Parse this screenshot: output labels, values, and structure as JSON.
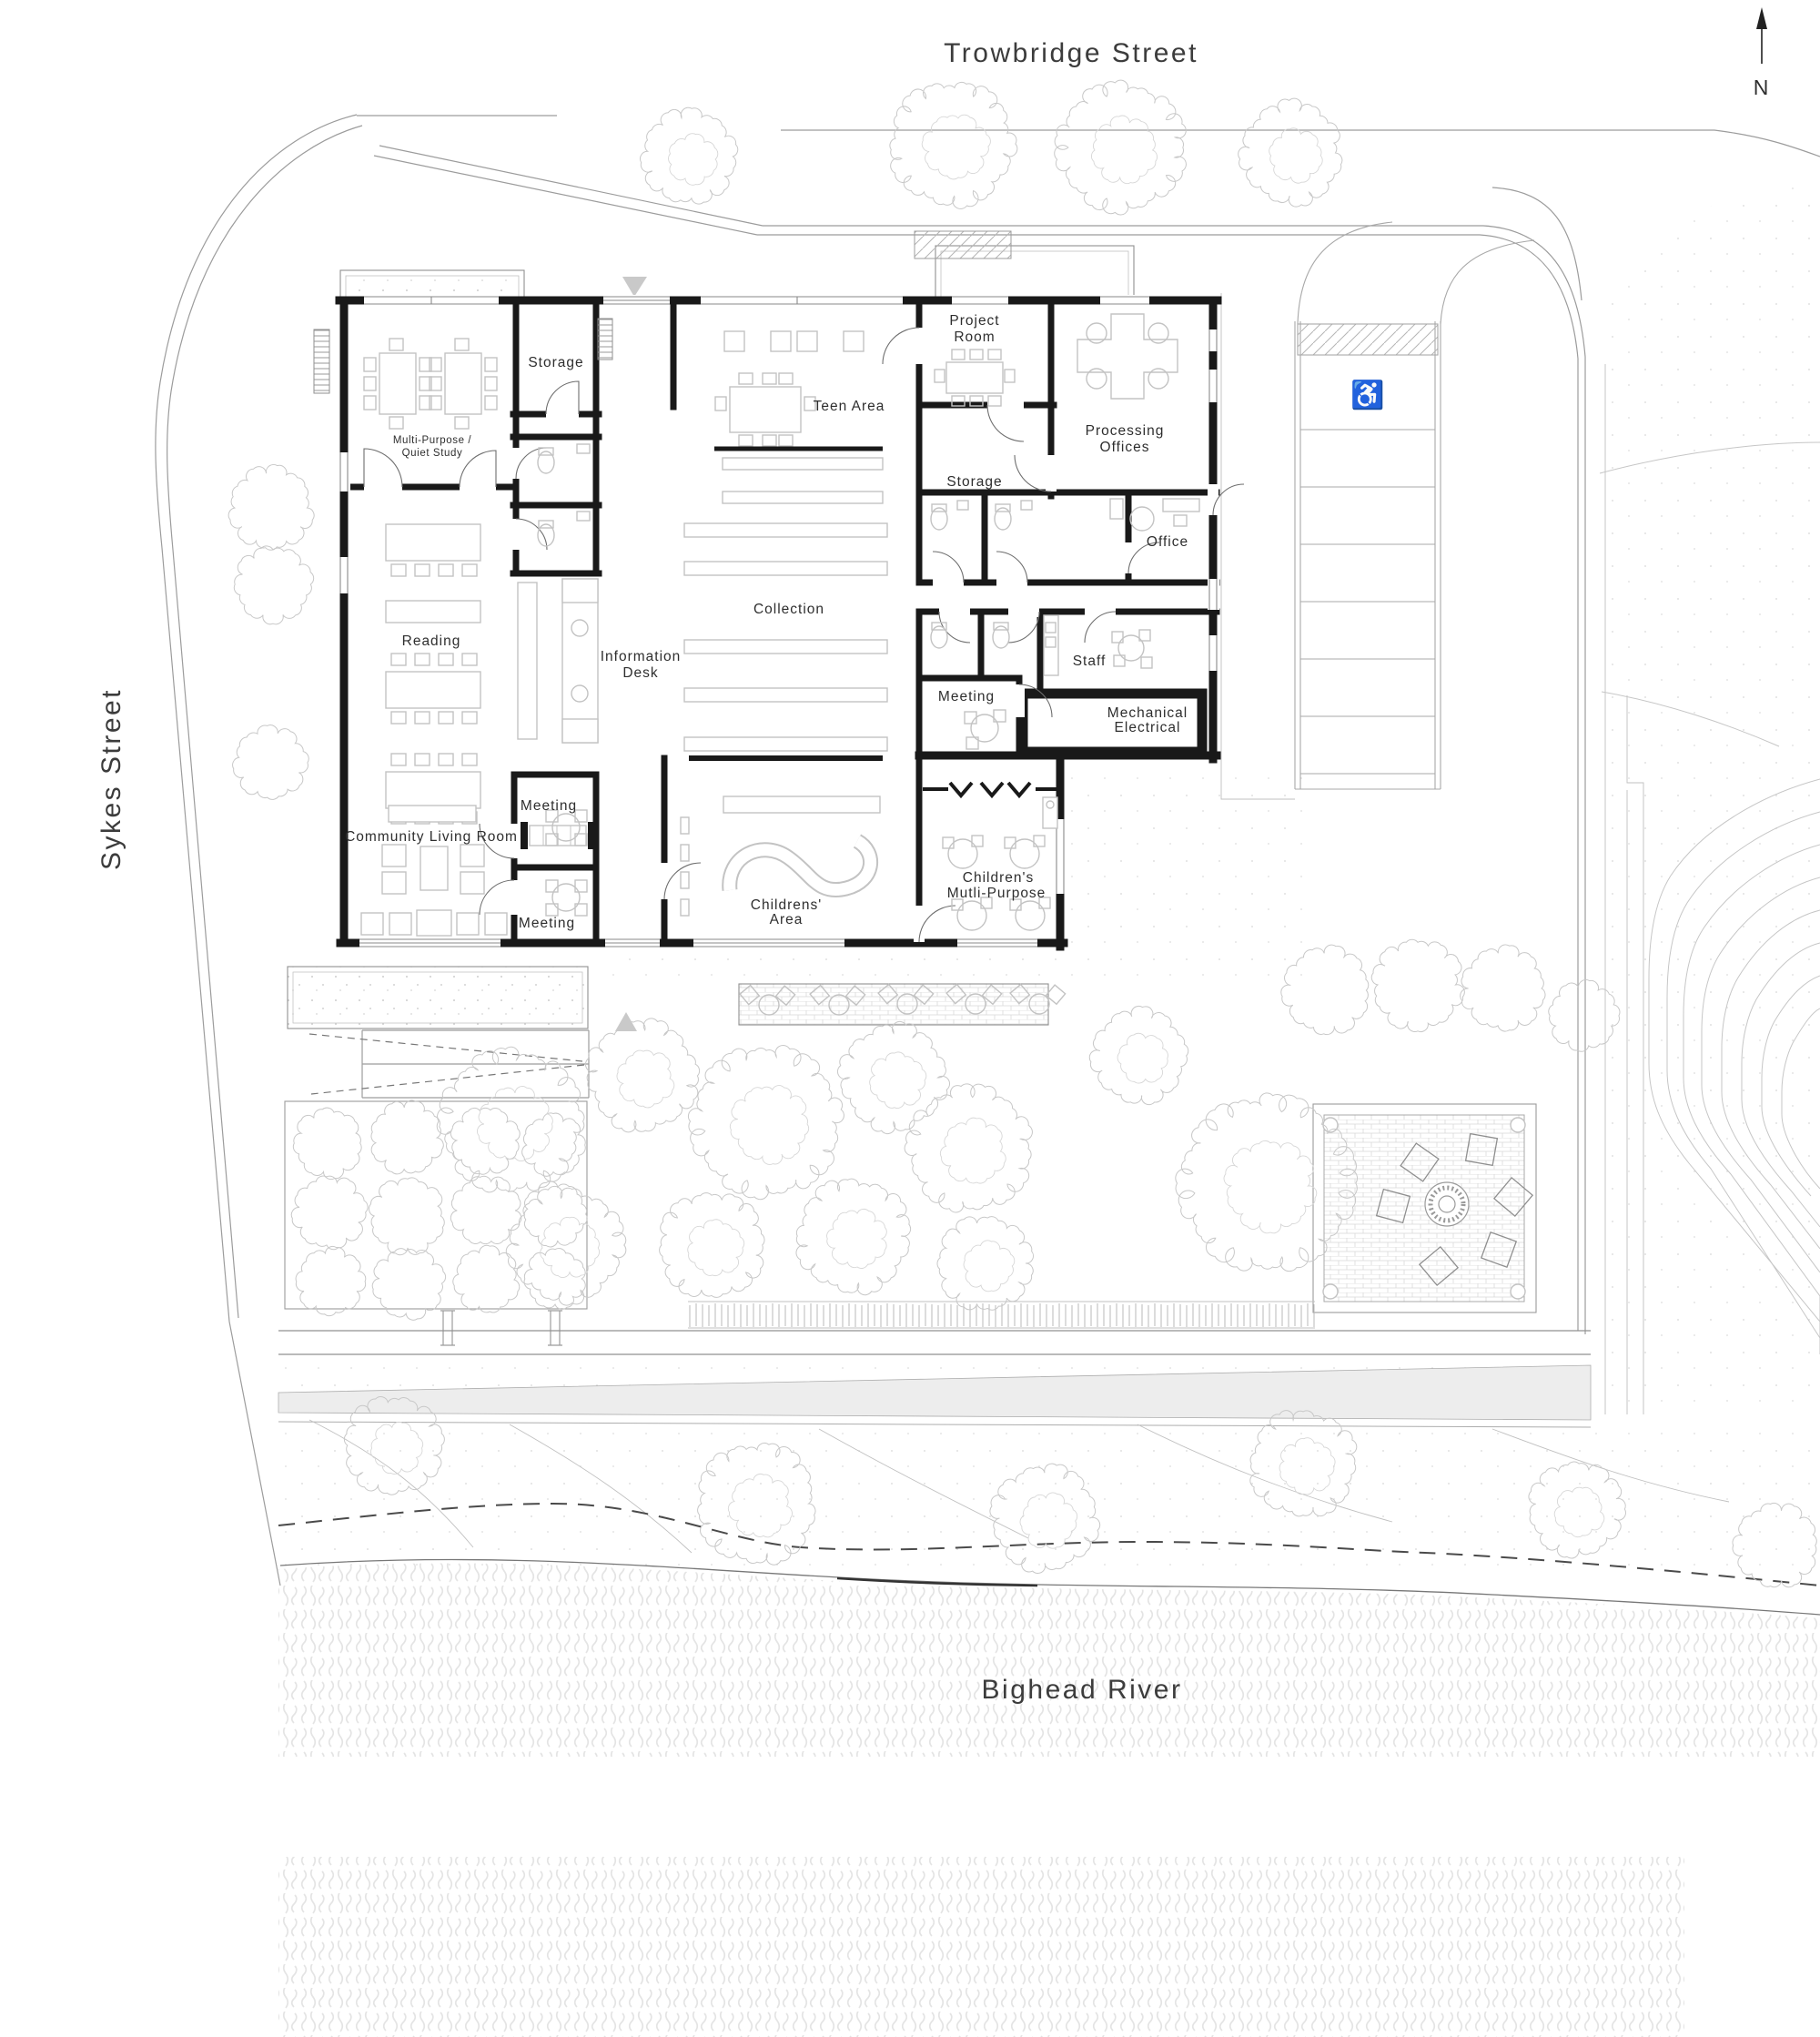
{
  "plan": {
    "streets": {
      "north": "Trowbridge Street",
      "west": "Sykes Street",
      "river": "Bighead River"
    },
    "north_indicator": "N",
    "icons": {
      "accessible_parking": "♿"
    },
    "rooms": [
      {
        "id": "storage-north",
        "lines": [
          "Storage"
        ]
      },
      {
        "id": "multi-purpose",
        "lines": [
          "Multi-Purpose /",
          "Quiet Study"
        ]
      },
      {
        "id": "teen-area",
        "lines": [
          "Teen Area"
        ]
      },
      {
        "id": "project-room",
        "lines": [
          "Project",
          "Room"
        ]
      },
      {
        "id": "processing-offices",
        "lines": [
          "Processing",
          "Offices"
        ]
      },
      {
        "id": "storage-central",
        "lines": [
          "Storage"
        ]
      },
      {
        "id": "office",
        "lines": [
          "Office"
        ]
      },
      {
        "id": "collection",
        "lines": [
          "Collection"
        ]
      },
      {
        "id": "reading",
        "lines": [
          "Reading"
        ]
      },
      {
        "id": "information-desk",
        "lines": [
          "Information",
          "Desk"
        ]
      },
      {
        "id": "staff",
        "lines": [
          "Staff"
        ]
      },
      {
        "id": "meeting-east",
        "lines": [
          "Meeting"
        ]
      },
      {
        "id": "mechanical-electrical",
        "lines": [
          "Mechanical",
          "Electrical"
        ]
      },
      {
        "id": "meeting-west-upper",
        "lines": [
          "Meeting"
        ]
      },
      {
        "id": "community-living-room",
        "lines": [
          "Community Living Room"
        ]
      },
      {
        "id": "meeting-west-lower",
        "lines": [
          "Meeting"
        ]
      },
      {
        "id": "childrens-area",
        "lines": [
          "Childrens'",
          "Area"
        ]
      },
      {
        "id": "childrens-multi-purpose",
        "lines": [
          "Children's",
          "Mutli-Purpose"
        ]
      }
    ],
    "colors": {
      "walls": "#191919",
      "site_lines": "#9c9c9c",
      "trees": "#c8c8c8",
      "water": "#e4e4e4",
      "paper": "#ffffff"
    }
  }
}
